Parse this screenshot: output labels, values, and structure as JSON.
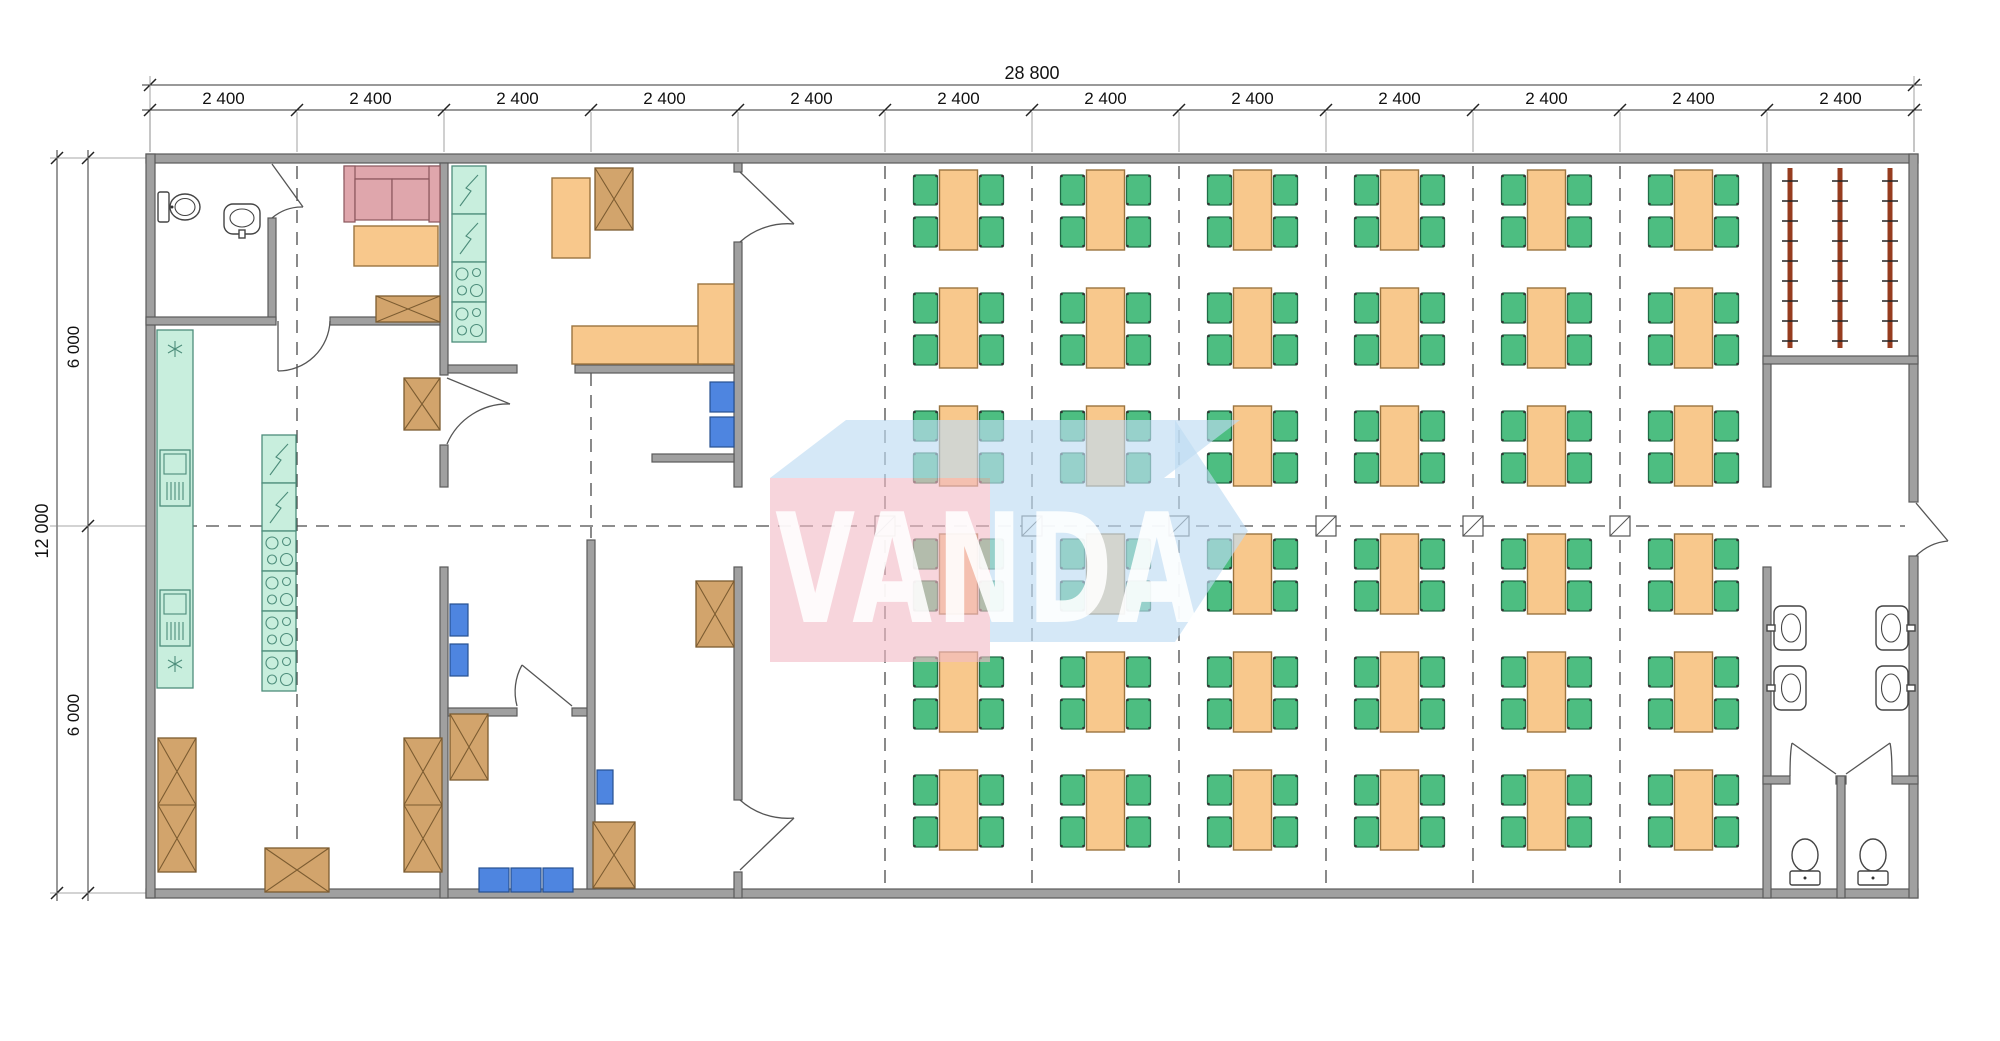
{
  "watermark": {
    "text": "VANDA"
  },
  "dimensions": {
    "overall_width": "28 800",
    "module_width": "2 400",
    "module_count": 12,
    "overall_depth": "12 000",
    "bay_depths": [
      "6 000",
      "6 000"
    ]
  },
  "dining": {
    "rows": 6,
    "columns": 6,
    "seats_per_table": 4
  },
  "equipment_counts": {
    "dining_tables": 36,
    "chairs_per_table": 4,
    "toilets": 3,
    "washbasins": 5,
    "sofas": 1,
    "drying_racks": 3,
    "storage_crates": 9
  },
  "colors": {
    "wall": "#a0a0a0",
    "table": "#f8c88c",
    "chair": "#4dbe81",
    "counter": "#c8eedd",
    "crate": "#d2a46c",
    "seat": "#4e85e0",
    "sofa": "#dfa6ac",
    "rack": "#963c1f",
    "wm_pink": "#f2bcc6",
    "wm_blue": "#bedcf2"
  }
}
